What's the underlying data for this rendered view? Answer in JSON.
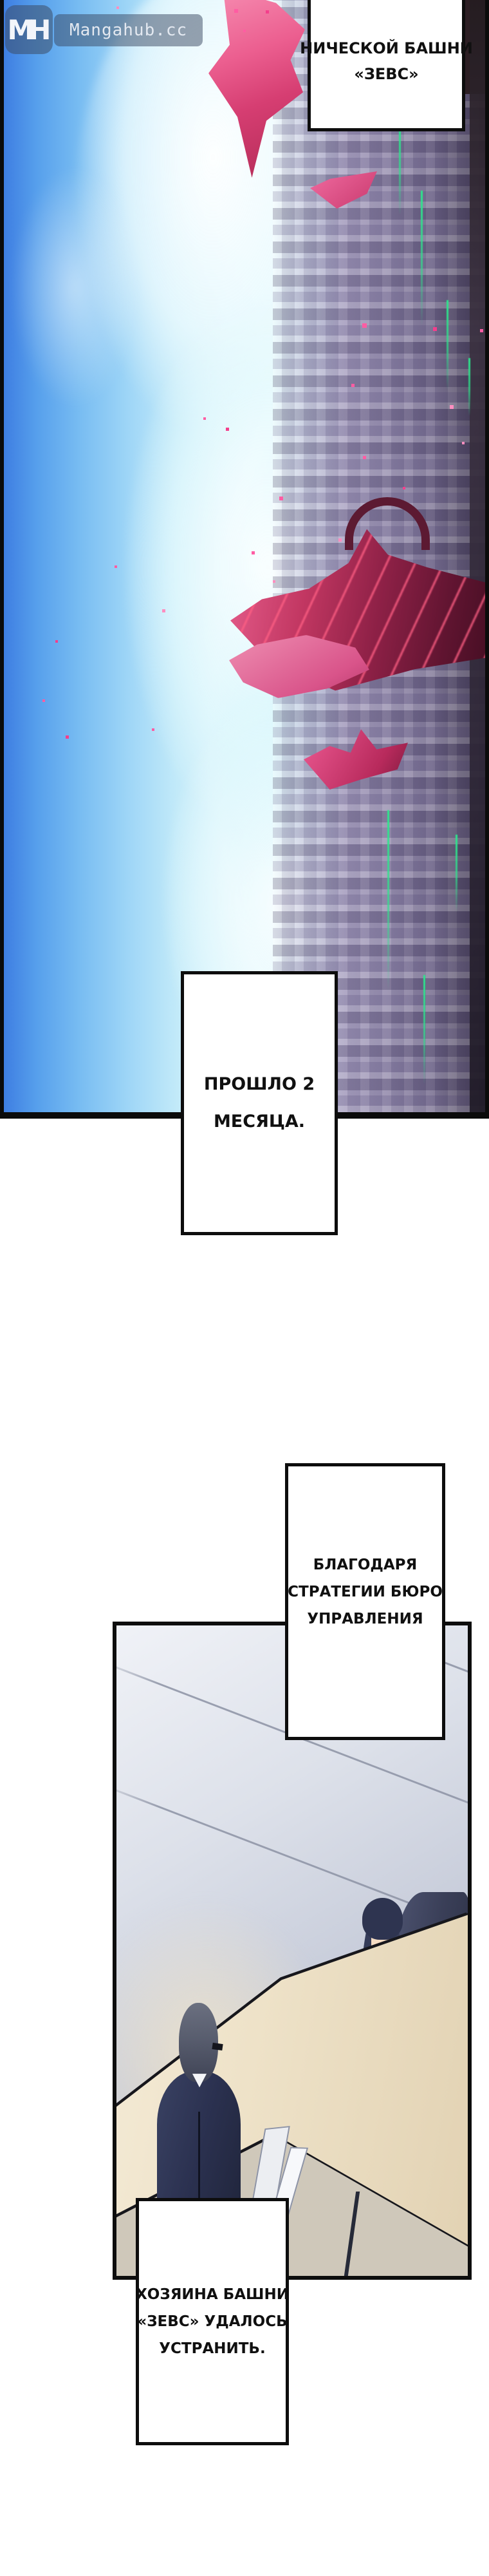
{
  "site": {
    "logo_monogram": "MH",
    "name": "Mangahub.cc"
  },
  "captions": {
    "box1": {
      "lines": [
        "НИЧЕСКОЙ БАШНИ",
        "«ЗЕВС»"
      ]
    },
    "box2": {
      "lines": [
        "ПРОШЛО 2",
        "МЕСЯЦА."
      ]
    },
    "box3": {
      "lines": [
        "БЛАГОДАРЯ",
        "СТРАТЕГИИ БЮРО",
        "УПРАВЛЕНИЯ"
      ]
    },
    "box4": {
      "lines": [
        "ХОЗЯИНА БАШНИ",
        "«ЗЕВС» УДАЛОСЬ",
        "УСТРАНИТЬ."
      ]
    }
  },
  "colors": {
    "sky_blue": "#57a0ec",
    "cloud_cyan": "#50d4f2",
    "city_purple": "#877da2",
    "neon_green": "#2ee58d",
    "wreck_red": "#c23762",
    "particle_pink": "#ff5da3",
    "desk_beige": "#eee2c8",
    "wall_grey": "#c6cbd9",
    "suit_navy": "#2b3150",
    "teal_accent": "#54d2b4",
    "panel_border": "#0d0d0d",
    "watermark_bg": "rgba(56,70,95,0.5)"
  }
}
